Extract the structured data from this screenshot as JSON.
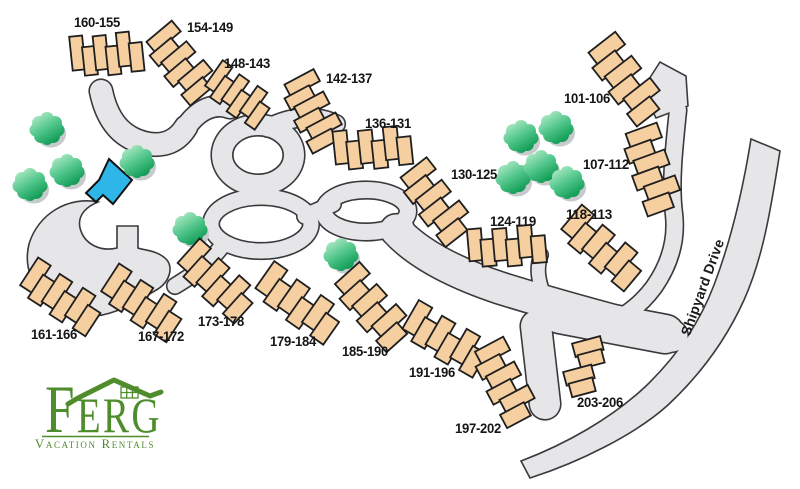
{
  "map": {
    "street_label": "Shipyard Drive",
    "colors": {
      "building": "#F6CFA1",
      "building_outline": "#1f1f1f",
      "road_fill": "#E6E6E8",
      "road_outline": "#3A3A3C",
      "pool": "#2EB6E9",
      "pool_outline": "#111111",
      "tree_light": "#B2EBC8",
      "tree_mid": "#52C68C",
      "tree_dark": "#0D9A52",
      "tree_shadow": "#C7CACD",
      "label": "#151515"
    },
    "buildings": [
      {
        "label": "160-155",
        "x": 107,
        "y": 55,
        "rot": -6,
        "units": 6,
        "uw": 13,
        "uh": 34,
        "lx": 97,
        "ly": 27
      },
      {
        "label": "154-149",
        "x": 180,
        "y": 64,
        "rot": 50,
        "units": 6,
        "uw": 14,
        "uh": 33,
        "lx": 210,
        "ly": 32
      },
      {
        "label": "148-143",
        "x": 238,
        "y": 96,
        "rot": 35,
        "units": 6,
        "uw": 12,
        "uh": 31,
        "lx": 247,
        "ly": 68
      },
      {
        "label": "142-137",
        "x": 312,
        "y": 112,
        "rot": 62,
        "units": 6,
        "uw": 13.5,
        "uh": 33,
        "lx": 349,
        "ly": 83
      },
      {
        "label": "136-131",
        "x": 373,
        "y": 149,
        "rot": -6,
        "units": 6,
        "uw": 14,
        "uh": 33,
        "lx": 388,
        "ly": 128
      },
      {
        "label": "130-125",
        "x": 435,
        "y": 203,
        "rot": 52,
        "units": 6,
        "uw": 15,
        "uh": 33,
        "lx": 474,
        "ly": 179
      },
      {
        "label": "124-119",
        "x": 507,
        "y": 247,
        "rot": -5,
        "units": 6,
        "uw": 14,
        "uh": 32,
        "lx": 513,
        "ly": 226
      },
      {
        "label": "101-106",
        "x": 625,
        "y": 80,
        "rot": 52,
        "units": 6,
        "uw": 16,
        "uh": 34,
        "lx": 587,
        "ly": 103
      },
      {
        "label": "107-112",
        "x": 651,
        "y": 170,
        "rot": 70,
        "units": 6,
        "uw": 15.5,
        "uh": 33,
        "lx": 606,
        "ly": 169
      },
      {
        "label": "118-113",
        "x": 602,
        "y": 249,
        "rot": 40,
        "units": 6,
        "uw": 16,
        "uh": 32,
        "lx": 589,
        "ly": 219
      },
      {
        "label": "161-166",
        "x": 61,
        "y": 298,
        "rot": 33,
        "units": 6,
        "uw": 15,
        "uh": 33,
        "lx": 54,
        "ly": 339
      },
      {
        "label": "167-172",
        "x": 142,
        "y": 304,
        "rot": 33,
        "units": 6,
        "uw": 15,
        "uh": 33,
        "lx": 161,
        "ly": 341
      },
      {
        "label": "173-178",
        "x": 216,
        "y": 282,
        "rot": 42,
        "units": 6,
        "uw": 15,
        "uh": 33,
        "lx": 221,
        "ly": 326
      },
      {
        "label": "179-184",
        "x": 298,
        "y": 304,
        "rot": 35,
        "units": 6,
        "uw": 16,
        "uh": 33,
        "lx": 293,
        "ly": 346
      },
      {
        "label": "185-190",
        "x": 372,
        "y": 308,
        "rot": 48,
        "units": 6,
        "uw": 15.5,
        "uh": 33,
        "lx": 365,
        "ly": 356
      },
      {
        "label": "191-196",
        "x": 445,
        "y": 340,
        "rot": 30,
        "units": 6,
        "uw": 15.5,
        "uh": 33,
        "lx": 432,
        "ly": 377
      },
      {
        "label": "197-202",
        "x": 504,
        "y": 383,
        "rot": 62,
        "units": 6,
        "uw": 15,
        "uh": 32,
        "lx": 478,
        "ly": 433
      },
      {
        "label": "203-206",
        "x": 585,
        "y": 367,
        "rot": 75,
        "units": 4,
        "uw": 14,
        "uh": 29,
        "offsets": [
          -8,
          -8,
          8,
          8
        ],
        "lx": 600,
        "ly": 407
      }
    ],
    "trees": [
      {
        "x": 47,
        "y": 128
      },
      {
        "x": 30,
        "y": 184
      },
      {
        "x": 67,
        "y": 170
      },
      {
        "x": 137,
        "y": 161
      },
      {
        "x": 190,
        "y": 228
      },
      {
        "x": 341,
        "y": 254
      },
      {
        "x": 521,
        "y": 136
      },
      {
        "x": 556,
        "y": 127
      },
      {
        "x": 513,
        "y": 177
      },
      {
        "x": 541,
        "y": 166
      },
      {
        "x": 567,
        "y": 182
      }
    ],
    "pool": {
      "points": "109,159 132,180 113,204 103,195 96,202 86,193 99,180"
    }
  },
  "logo": {
    "initial": "F",
    "rest": "ERG",
    "tagline": "Vacation Rentals",
    "color": "#4F8D2C"
  }
}
